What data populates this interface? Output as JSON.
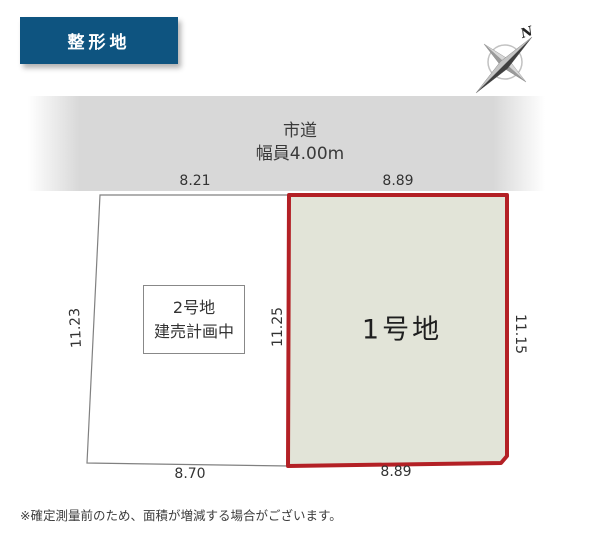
{
  "badge": {
    "label": "整形地",
    "bg_color": "#0e5480"
  },
  "compass": {
    "label": "N"
  },
  "road": {
    "name": "市道",
    "width_label": "幅員4.00m"
  },
  "plots": {
    "plot2": {
      "label_line1": "2号地",
      "label_line2": "建売計画中",
      "dims": {
        "top": "8.21",
        "left": "11.23",
        "bottom": "8.70"
      }
    },
    "plot1": {
      "label": "1号地",
      "dims": {
        "top": "8.89",
        "left": "11.25",
        "right": "11.15",
        "bottom": "8.89"
      },
      "border_color": "#b32025",
      "fill_color": "#e2e4d8"
    }
  },
  "footnote": "※確定測量前のため、面積が増減する場合がございます。"
}
